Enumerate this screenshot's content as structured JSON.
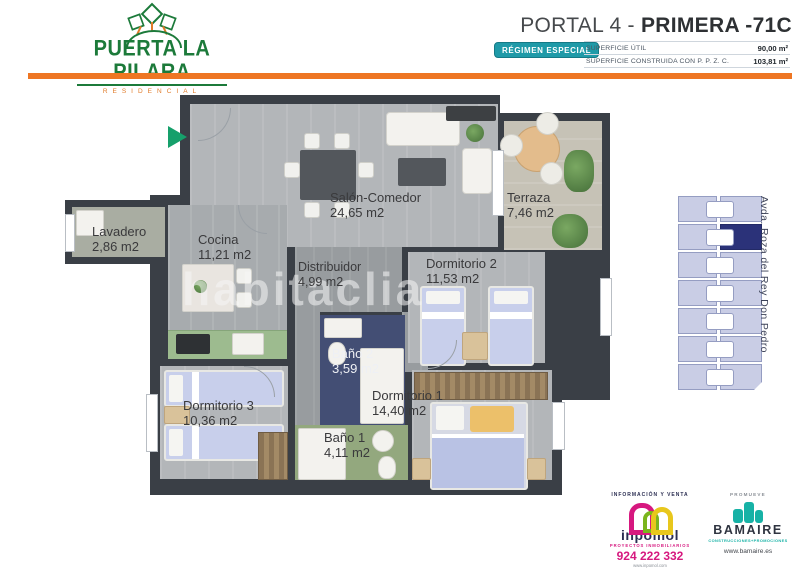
{
  "header": {
    "logo": {
      "title": "PUERTA LA PILARA",
      "subtitle": "RESIDENCIAL"
    },
    "title_regular": "PORTAL 4 - ",
    "title_bold": "PRIMERA -71C",
    "badge": "RÉGIMEN ESPECIAL",
    "surface_rows": [
      {
        "label": "SUPERFICIE ÚTIL",
        "value": "90,00 m²"
      },
      {
        "label": "SUPERFICIE  CONSTRUIDA CON P. P. Z. C.",
        "value": "103,81 m²"
      }
    ]
  },
  "floorplan": {
    "watermark": "habitaclia",
    "rooms": [
      {
        "name": "Salón-Comedor",
        "area": "24,65 m2"
      },
      {
        "name": "Terraza",
        "area": "7,46 m2"
      },
      {
        "name": "Lavadero",
        "area": "2,86 m2"
      },
      {
        "name": "Cocina",
        "area": "11,21 m2"
      },
      {
        "name": "Distribuidor",
        "area": "4,99 m2"
      },
      {
        "name": "Dormitorio 2",
        "area": "11,53 m2"
      },
      {
        "name": "Baño 2",
        "area": "3,59 m2"
      },
      {
        "name": "Dormitorio 3",
        "area": "10,36 m2"
      },
      {
        "name": "Baño 1",
        "area": "4,11 m2"
      },
      {
        "name": "Dormitorio 1",
        "area": "14,40 m2"
      }
    ]
  },
  "sitemap": {
    "street": "Avda. Roza del Rey Don Pedro"
  },
  "footer": {
    "inpomol": {
      "heading": "INFORMACIÓN Y VENTA",
      "name": "inpomol",
      "tagline": "PROYECTOS INMOBILIARIOS",
      "phone": "924 222 332",
      "website": "www.inpomol.com"
    },
    "bamaire": {
      "heading": "PROMUEVE",
      "name": "BAMAIRE",
      "tagline": "CONSTRUCCIONES+PROMOCIONES",
      "website": "www.bamaire.es"
    }
  },
  "colors": {
    "accent_orange": "#ee7623",
    "brand_green": "#1c7a3a",
    "badge_teal": "#1f9aa8",
    "unit_highlight_navy": "#2b3279",
    "inpomol_magenta": "#d6187f",
    "bamaire_teal": "#17b2a6",
    "wall_charcoal": "#3a3f46",
    "entrance_marker_green": "#16a06b"
  }
}
